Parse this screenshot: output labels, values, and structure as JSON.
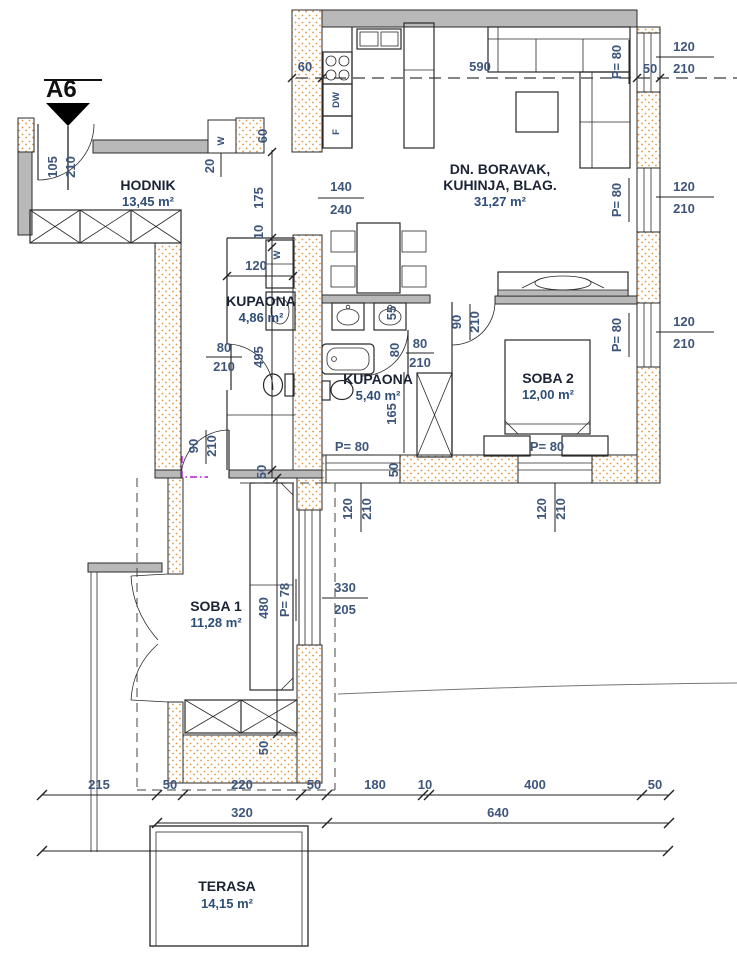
{
  "section_marker": "A6",
  "rooms": {
    "hodnik": {
      "name": "HODNIK",
      "area": "13,45 m²"
    },
    "living": {
      "name_line1": "DN. BORAVAK,",
      "name_line2": "KUHINJA, BLAG.",
      "area": "31,27 m²"
    },
    "bath1": {
      "name": "KUPAONA",
      "area": "4,86 m²"
    },
    "bath2": {
      "name": "KUPAONA",
      "area": "5,40 m²"
    },
    "soba2": {
      "name": "SOBA 2",
      "area": "12,00 m²"
    },
    "soba1": {
      "name": "SOBA 1",
      "area": "11,28 m²"
    },
    "terasa": {
      "name": "TERASA",
      "area": "14,15 m²"
    }
  },
  "appliances": {
    "dishwasher": "DW",
    "fridge": "F",
    "washer": "W"
  },
  "colors": {
    "wall_dot": "#e2943f",
    "concrete": "#b9b9b9",
    "dim_text": "#3e567c",
    "marker": "#b01fd0"
  },
  "dims": {
    "entry_door": {
      "w": "105",
      "h": "210"
    },
    "wall_20": "20",
    "opening_60": "60",
    "wall_60": "60",
    "living_width": "590",
    "window_140": "140",
    "window_240": "240",
    "corridor_175": "175",
    "gap_10": "10",
    "bath1_width": "120",
    "window_sill": "P= 80",
    "window_w": "120",
    "window_h": "210",
    "wall_50": "50",
    "bath1_door": {
      "w": "80",
      "h": "210"
    },
    "bath1_len": "495",
    "soba1_door": {
      "w": "90",
      "h": "210"
    },
    "bath2_55": "55",
    "bath2_80": "80",
    "bath2_door": {
      "w": "80",
      "h": "210"
    },
    "bath2_165": "165",
    "soba2_door": {
      "w": "90",
      "h": "210"
    },
    "bed_sill": "P= 78",
    "soba1_len": "480",
    "soba1_win": {
      "w": "330",
      "h": "205"
    },
    "chain1": [
      "215",
      "50",
      "220",
      "50",
      "180",
      "10",
      "400",
      "50"
    ],
    "chain2": [
      "320",
      "640"
    ]
  }
}
